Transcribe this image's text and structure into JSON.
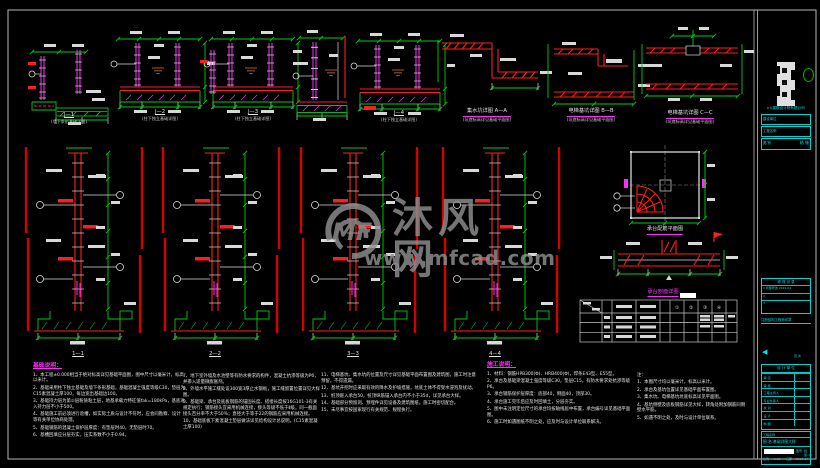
{
  "watermark": {
    "logo": "MF",
    "name": "沐风网",
    "url": "www.mfcad.com"
  },
  "captions": {
    "d1t": "J—1",
    "d1s": "(墙下条形基础详图)",
    "d2t": "J—2",
    "d2s": "(柱下独立基础详图)",
    "d3t": "J—3",
    "d3s": "(柱下独立基础详图)",
    "d5t": "J—4",
    "d5s": "(柱下独立基础详图)",
    "d6t": "集水坑详图 A—A",
    "d6s": "(坑底标高详见基础平面图)",
    "d7t": "电梯基坑详图 B—B",
    "d7s": "(坑底标高详见基础平面图)",
    "d8t": "电梯基坑详图 C—C",
    "d8s": "(坑底标高详见基础平面图)",
    "s1": "1—1",
    "s2": "2—2",
    "s3": "3—3",
    "s4": "4—4",
    "plan": "承台配筋平面图",
    "sec": "承台剖面详图"
  },
  "table": {
    "headers": [
      "①",
      "②",
      "③",
      "④"
    ]
  },
  "notes": {
    "col1_title": "基础说明：",
    "col1": [
      "1、本工程±0.000相当于绝对标高详见基础平面图，图中尺寸以毫米计，标高以米计。",
      "2、基础采用柱下独立基础及墙下条形基础，基础混凝土强度等级C30，垫层为C15素混凝土厚100，每边宽出基础边100。",
      "3、基础持力层为第②层粉质粘土层，地基承载力特征值fak=180kPa，基底进入持力层不小于500。",
      "4、基础施工前必须进行验槽，如实际土质与设计不符时，应会同勘察、设计等有关单位协商处理。",
      "5、基础钢筋的混凝土保护层厚度：有垫层时40，无垫层时70。",
      "6、基槽回填应分层夯实，压实系数不小于0.94。"
    ],
    "col2": [
      "7、地下室外墙及水池壁等有防水要求的构件，混凝土抗渗等级为P6，并掺入适量微膨胀剂。",
      "8、外墙水平施工缝处设300宽3厚止水钢板，施工缝留置位置详见大样图。",
      "9、基础梁、承台及底板钢筋的锚固长度、搭接长度按16G101-3有关规定执行；钢筋接头宜采用机械连接，接头等级不低于Ⅱ级，同一截面接头百分率不大于50%；直径大于等于22的钢筋应采用机械连接。",
      "10、基础底板下素混凝土垫层做法详见结构设计总说明。(C15素混凝土厚100)"
    ],
    "col3": [
      "11、电梯基坑、集水坑的位置及尺寸详见基础平面布置图及建筑图，施工时注意预留，不得遗漏。",
      "12、基坑开挖时应采取有效的降水及护坡措施，坑底土体不得受水浸泡及扰动。",
      "13、桩顶嵌入承台50，桩顶纵筋锚入承台内不小于35d，详见承台大样。",
      "14、基础部分预留洞、预埋件详见设备及建筑图纸，施工时密切配合。",
      "15、未尽事宜按国家现行有关规范、规程执行。"
    ],
    "col4_title": "施工说明：",
    "col4": [
      "1、材料：钢筋HPB300(Φ)、HRB400(Φ)，焊条E43型、E55型。",
      "2、承台及基础梁混凝土强度等级C30，垫层C15，有防水要求处抗渗等级P6。",
      "3、承台钢筋保护层厚度：底部40，侧面40，顶部30。",
      "4、承台施工完毕后应及时回填土，分层夯实。",
      "5、图中未注明定位尺寸的承台均按轴线居中布置，承台编号详见基础平面图。",
      "6、施工时如遇图纸不明之处，应及时与设计单位联系解决。"
    ],
    "col5": [
      "注：",
      "1、本图尺寸均以毫米计，标高以米计。",
      "2、承台及基坑位置详见基础平面布置图。",
      "3、集水坑、电梯基坑坑底标高详见平面图。",
      "4、基坑侧壁及底板钢筋详见大样，转角处附加钢筋同侧壁水平筋。",
      "5、如遇不明之处，及时与设计单位联系。"
    ]
  },
  "titleblock": {
    "firm": "××建筑设计院有限公司",
    "box1": "建设单位",
    "box2": "工程名称",
    "box3": "图 别",
    "box3v": "结 施",
    "rev_title": "修 改 记 录",
    "rev_lines": [
      "1  局部修改  2019.04",
      "2",
      "3"
    ],
    "cert": "注册结构工程师印章",
    "page": "页 次",
    "sign_title": "设 计 单 位",
    "sign_rows": [
      "审 定",
      "审 核",
      "工程主持人",
      "专业负责人",
      "校 对",
      "设 计",
      "制 图"
    ],
    "proj_label": "工程名称",
    "name_label": "图 名",
    "drawing_name": "基础详图大样",
    "scale_label": "比例",
    "scale": "1:50",
    "date_label": "日期",
    "date": "2019.04",
    "no_label": "图号",
    "no": "结施-12"
  }
}
